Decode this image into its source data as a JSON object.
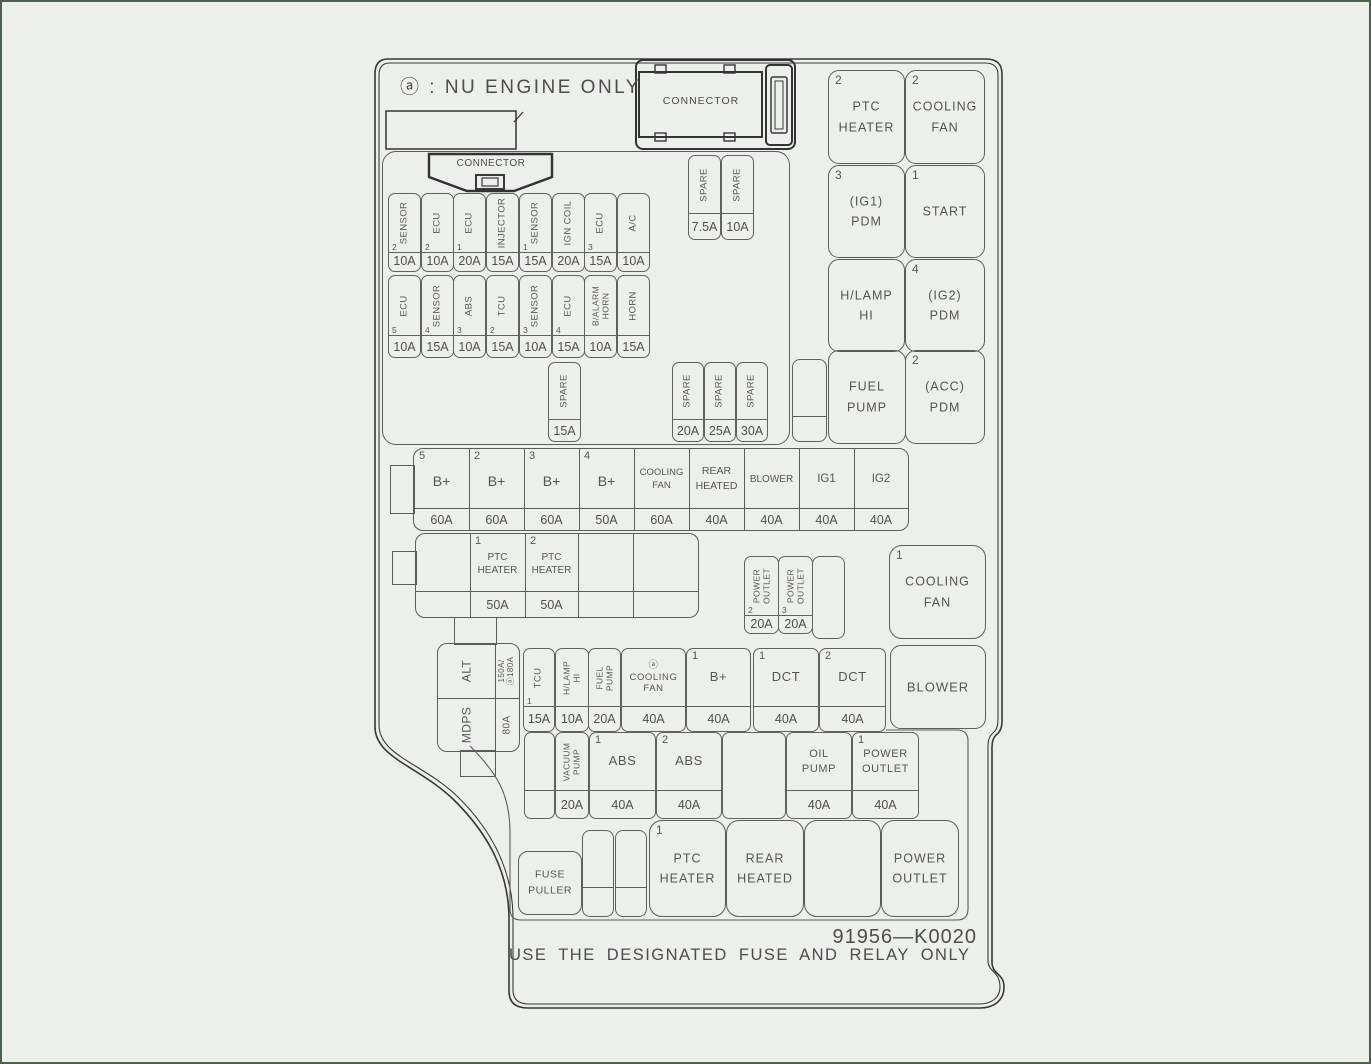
{
  "colors": {
    "background": "#edefec",
    "frame": "#4a614b",
    "line": "#5c5c5c",
    "text": "#545454"
  },
  "notes": {
    "engine_note": "ⓐ : NU ENGINE ONLY",
    "part_number": "91956—K0020",
    "warning": "USE THE DESIGNATED FUSE AND RELAY ONLY"
  },
  "connector_top": {
    "label": "CONNECTOR"
  },
  "connector_inner": {
    "label": "CONNECTOR"
  },
  "fuse_row1": [
    {
      "num": "2",
      "label": "SENSOR",
      "amp": "10A"
    },
    {
      "num": "2",
      "label": "ECU",
      "amp": "10A"
    },
    {
      "num": "1",
      "label": "ECU",
      "amp": "20A"
    },
    {
      "num": "",
      "label": "INJECTOR",
      "amp": "15A"
    },
    {
      "num": "1",
      "label": "SENSOR",
      "amp": "15A"
    },
    {
      "num": "",
      "label": "IGN COIL",
      "amp": "20A"
    },
    {
      "num": "3",
      "label": "ECU",
      "amp": "15A"
    },
    {
      "num": "",
      "label": "A/C",
      "amp": "10A"
    }
  ],
  "fuse_row2": [
    {
      "num": "5",
      "label": "ECU",
      "amp": "10A"
    },
    {
      "num": "4",
      "label": "SENSOR",
      "amp": "15A"
    },
    {
      "num": "3",
      "label": "ABS",
      "amp": "10A"
    },
    {
      "num": "2",
      "label": "TCU",
      "amp": "15A"
    },
    {
      "num": "3",
      "label": "SENSOR",
      "amp": "10A"
    },
    {
      "num": "4",
      "label": "ECU",
      "amp": "15A"
    },
    {
      "num": "",
      "label": "B/ALARM\nHORN",
      "amp": "10A"
    },
    {
      "num": "",
      "label": "HORN",
      "amp": "15A"
    }
  ],
  "spares_top": [
    {
      "label": "SPARE",
      "amp": "7.5A"
    },
    {
      "label": "SPARE",
      "amp": "10A"
    }
  ],
  "spare_mid": {
    "label": "SPARE",
    "amp": "15A"
  },
  "spares_mid3": [
    {
      "label": "SPARE",
      "amp": "20A"
    },
    {
      "label": "SPARE",
      "amp": "25A"
    },
    {
      "label": "SPARE",
      "amp": "30A"
    }
  ],
  "relays_right": {
    "ptc_heater": {
      "num": "2",
      "label": "PTC\nHEATER"
    },
    "cooling_fan": {
      "num": "2",
      "label": "COOLING\nFAN"
    },
    "ig1_pdm": {
      "num": "3",
      "label": "(IG1)\nPDM"
    },
    "start": {
      "num": "1",
      "label": "START"
    },
    "hlamp_hi": {
      "num": "",
      "label": "H/LAMP\nHI"
    },
    "ig2_pdm": {
      "num": "4",
      "label": "(IG2)\nPDM"
    },
    "fuel_pump": {
      "num": "",
      "label": "FUEL\nPUMP"
    },
    "acc_pdm": {
      "num": "2",
      "label": "(ACC)\nPDM"
    }
  },
  "bplus_block": [
    {
      "num": "5",
      "label": "B+",
      "amp": "60A"
    },
    {
      "num": "2",
      "label": "B+",
      "amp": "60A"
    },
    {
      "num": "3",
      "label": "B+",
      "amp": "60A"
    },
    {
      "num": "4",
      "label": "B+",
      "amp": "50A"
    },
    {
      "num": "",
      "label": "COOLING\nFAN",
      "amp": "60A"
    },
    {
      "num": "",
      "label": "REAR\nHEATED",
      "amp": "40A"
    },
    {
      "num": "",
      "label": "BLOWER",
      "amp": "40A"
    },
    {
      "num": "",
      "label": "IG1",
      "amp": "40A"
    },
    {
      "num": "",
      "label": "IG2",
      "amp": "40A"
    }
  ],
  "ptc_block": [
    {
      "num": "1",
      "label": "PTC\nHEATER",
      "amp": "50A"
    },
    {
      "num": "2",
      "label": "PTC\nHEATER",
      "amp": "50A"
    }
  ],
  "power_outlet_fuses": [
    {
      "num": "2",
      "label": "POWER\nOUTLET",
      "amp": "20A"
    },
    {
      "num": "3",
      "label": "POWER\nOUTLET",
      "amp": "20A"
    }
  ],
  "cooling_fan_relay1": {
    "num": "1",
    "label": "COOLING\nFAN"
  },
  "alt_block": {
    "alt_label": "ALT",
    "alt_amp": "150A/\nⓐ180A",
    "mdps_label": "MDPS",
    "mdps_amp": "80A"
  },
  "mid_row": {
    "tcu": {
      "num": "1",
      "label": "TCU",
      "amp": "15A"
    },
    "hlamp": {
      "label": "H/LAMP\nHI",
      "amp": "10A"
    },
    "fuel_pump": {
      "label": "FUEL\nPUMP",
      "amp": "20A"
    },
    "cooling_fan": {
      "label": "ⓐ\nCOOLING\nFAN",
      "amp": "40A"
    },
    "bplus": {
      "num": "1",
      "label": "B+",
      "amp": "40A"
    },
    "dct1": {
      "num": "1",
      "label": "DCT",
      "amp": "40A"
    },
    "dct2": {
      "num": "2",
      "label": "DCT",
      "amp": "40A"
    },
    "blower": {
      "label": "BLOWER"
    }
  },
  "low_row": {
    "vacuum": {
      "label": "VACUUM\nPUMP",
      "amp": "20A"
    },
    "abs1": {
      "num": "1",
      "label": "ABS",
      "amp": "40A"
    },
    "abs2": {
      "num": "2",
      "label": "ABS",
      "amp": "40A"
    },
    "oil_pump": {
      "label": "OIL\nPUMP",
      "amp": "40A"
    },
    "power_outlet1": {
      "num": "1",
      "label": "POWER\nOUTLET",
      "amp": "40A"
    }
  },
  "bottom_row": {
    "fuse_puller": {
      "label": "FUSE\nPULLER"
    },
    "ptc_heater": {
      "num": "1",
      "label": "PTC\nHEATER"
    },
    "rear_heated": {
      "label": "REAR\nHEATED"
    },
    "power_outlet": {
      "label": "POWER\nOUTLET"
    }
  }
}
